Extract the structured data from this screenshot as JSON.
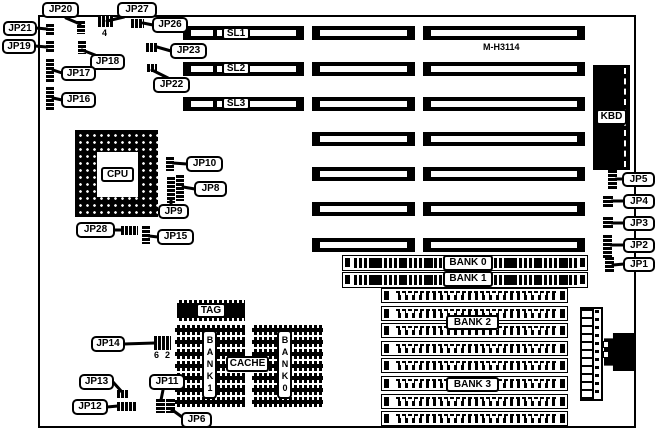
{
  "diagram": {
    "model": "M-H3114",
    "cpu_label": "CPU",
    "kbd_label": "KBD",
    "tag_label": "TAG",
    "cache_label": "CACHE",
    "slot_labels": {
      "sl1": "SL1",
      "sl2": "SL2",
      "sl3": "SL3"
    },
    "memory_banks": {
      "bank0": "BANK 0",
      "bank1": "BANK 1",
      "bank2": "BANK 2",
      "bank3": "BANK 3"
    },
    "cache_banks": {
      "bank1": "BANK1",
      "bank0": "BANK0"
    },
    "pin_markers": {
      "jp27_pin": "4",
      "jp14_pin_a": "6",
      "jp14_pin_b": "2"
    },
    "jumper_labels": {
      "jp1": "JP1",
      "jp2": "JP2",
      "jp3": "JP3",
      "jp4": "JP4",
      "jp5": "JP5",
      "jp6": "JP6",
      "jp8": "JP8",
      "jp9": "JP9",
      "jp10": "JP10",
      "jp11": "JP11",
      "jp12": "JP12",
      "jp13": "JP13",
      "jp14": "JP14",
      "jp15": "JP15",
      "jp16": "JP16",
      "jp17": "JP17",
      "jp18": "JP18",
      "jp19": "JP19",
      "jp20": "JP20",
      "jp21": "JP21",
      "jp22": "JP22",
      "jp23": "JP23",
      "jp26": "JP26",
      "jp27": "JP27",
      "jp28": "JP28"
    }
  }
}
